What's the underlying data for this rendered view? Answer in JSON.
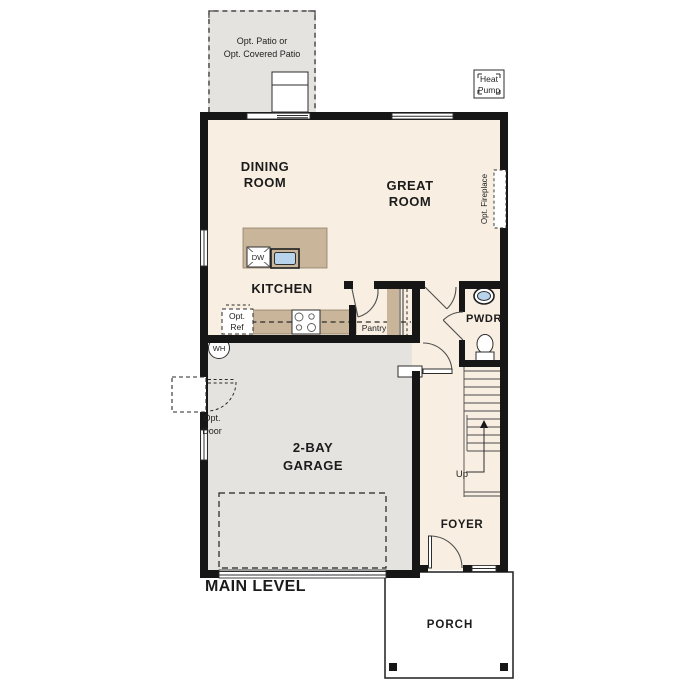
{
  "title": "MAIN LEVEL",
  "colors": {
    "floor": "#f8efe2",
    "concrete": "#e4e3e0",
    "counter": "#c8b59a",
    "water": "#b8d3ec",
    "wall": "#161616"
  },
  "rooms": {
    "dining": {
      "line1": "DINING",
      "line2": "ROOM"
    },
    "great": {
      "line1": "GREAT",
      "line2": "ROOM"
    },
    "kitchen": {
      "label": "KITCHEN"
    },
    "garage": {
      "line1": "2-BAY",
      "line2": "GARAGE"
    },
    "pwdr": {
      "label": "PWDR"
    },
    "foyer": {
      "label": "FOYER"
    },
    "porch": {
      "label": "PORCH"
    },
    "pantry": {
      "label": "Pantry"
    }
  },
  "annotations": {
    "patio": {
      "line1": "Opt. Patio or",
      "line2": "Opt. Covered Patio"
    },
    "heat_pump": {
      "line1": "Heat",
      "line2": "Pump"
    },
    "opt_fireplace": {
      "label": "Opt. Fireplace"
    },
    "opt_ref": {
      "line1": "Opt.",
      "line2": "Ref"
    },
    "opt_door": {
      "line1": "Opt.",
      "line2": "Door"
    },
    "wh": {
      "label": "WH"
    },
    "dw": {
      "label": "DW"
    },
    "up": {
      "label": "Up"
    }
  }
}
